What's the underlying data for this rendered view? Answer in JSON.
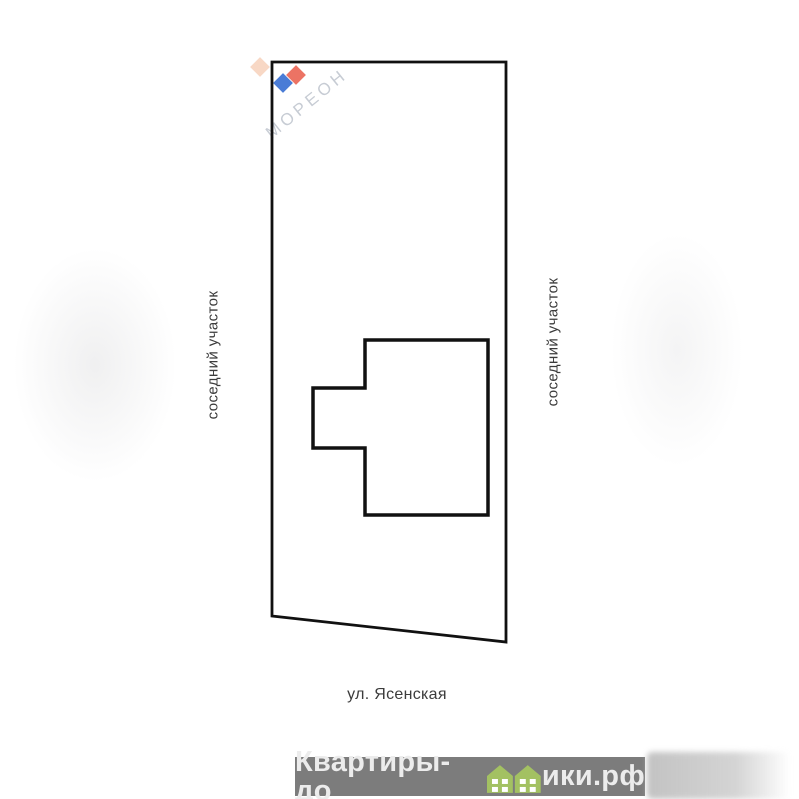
{
  "diagram": {
    "neighbor_label_left": "соседний участок",
    "neighbor_label_right": "соседний участок",
    "street_label": "ул. Ясенская",
    "line_color": "#111111"
  },
  "watermark_logo": {
    "text": "МОРЕОН",
    "text_color": "#c7ccd4",
    "diamond_colors": {
      "peach": "#f8d8c5",
      "red": "#ec7364",
      "blue": "#4a7cd6"
    }
  },
  "footer_watermark": {
    "text_before_icon": "Квартиры-до",
    "text_after_icon": "ики.рф",
    "band_color": "#7c7c7c",
    "text_color": "#ececec",
    "house_icon_color": "#a3c162"
  }
}
